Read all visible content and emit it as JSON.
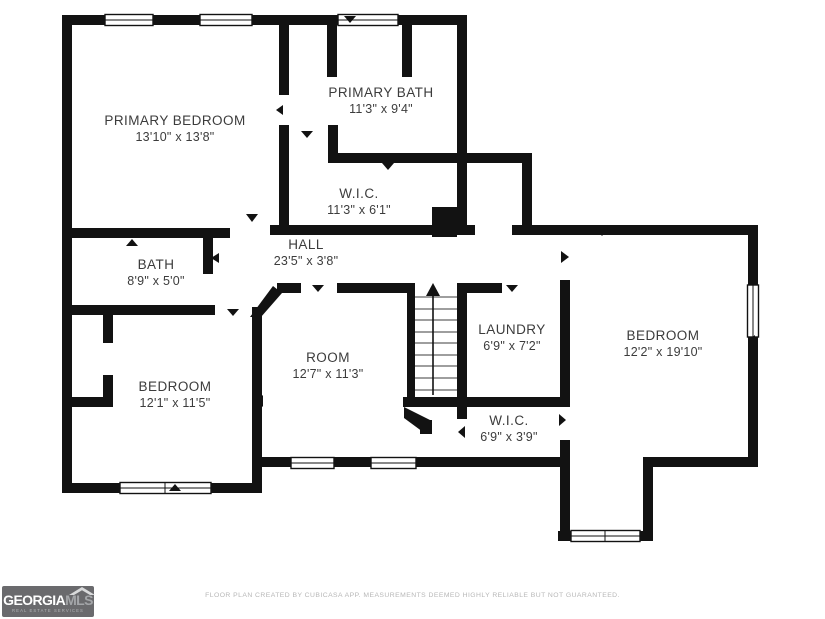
{
  "plan": {
    "rooms": [
      {
        "name": "PRIMARY BEDROOM",
        "dims": "13'10\" x 13'8\""
      },
      {
        "name": "PRIMARY BATH",
        "dims": "11'3\" x 9'4\""
      },
      {
        "name": "W.I.C.",
        "dims": "11'3\" x 6'1\""
      },
      {
        "name": "HALL",
        "dims": "23'5\" x 3'8\""
      },
      {
        "name": "BATH",
        "dims": "8'9\" x 5'0\""
      },
      {
        "name": "BEDROOM",
        "dims": "12'1\" x 11'5\""
      },
      {
        "name": "ROOM",
        "dims": "12'7\" x 11'3\""
      },
      {
        "name": "LAUNDRY",
        "dims": "6'9\" x 7'2\""
      },
      {
        "name": "W.I.C.",
        "dims": "6'9\" x 3'9\""
      },
      {
        "name": "BEDROOM",
        "dims": "12'2\" x 19'10\""
      }
    ]
  },
  "branding": {
    "logo_primary": "GEORGIA",
    "logo_secondary": "MLS",
    "logo_tagline": "REAL ESTATE SERVICES"
  },
  "footer": {
    "disclaimer": "FLOOR PLAN CREATED BY CUBICASA APP. MEASUREMENTS DEEMED HIGHLY RELIABLE BUT NOT GUARANTEED."
  },
  "colors": {
    "wall": "#121212",
    "label": "#3c3c3c",
    "logo_bg": "#6a6a6d",
    "logo_text": "#ffffff",
    "logo_accent": "#a4a6a9",
    "footer_text": "#b7b7b7"
  }
}
